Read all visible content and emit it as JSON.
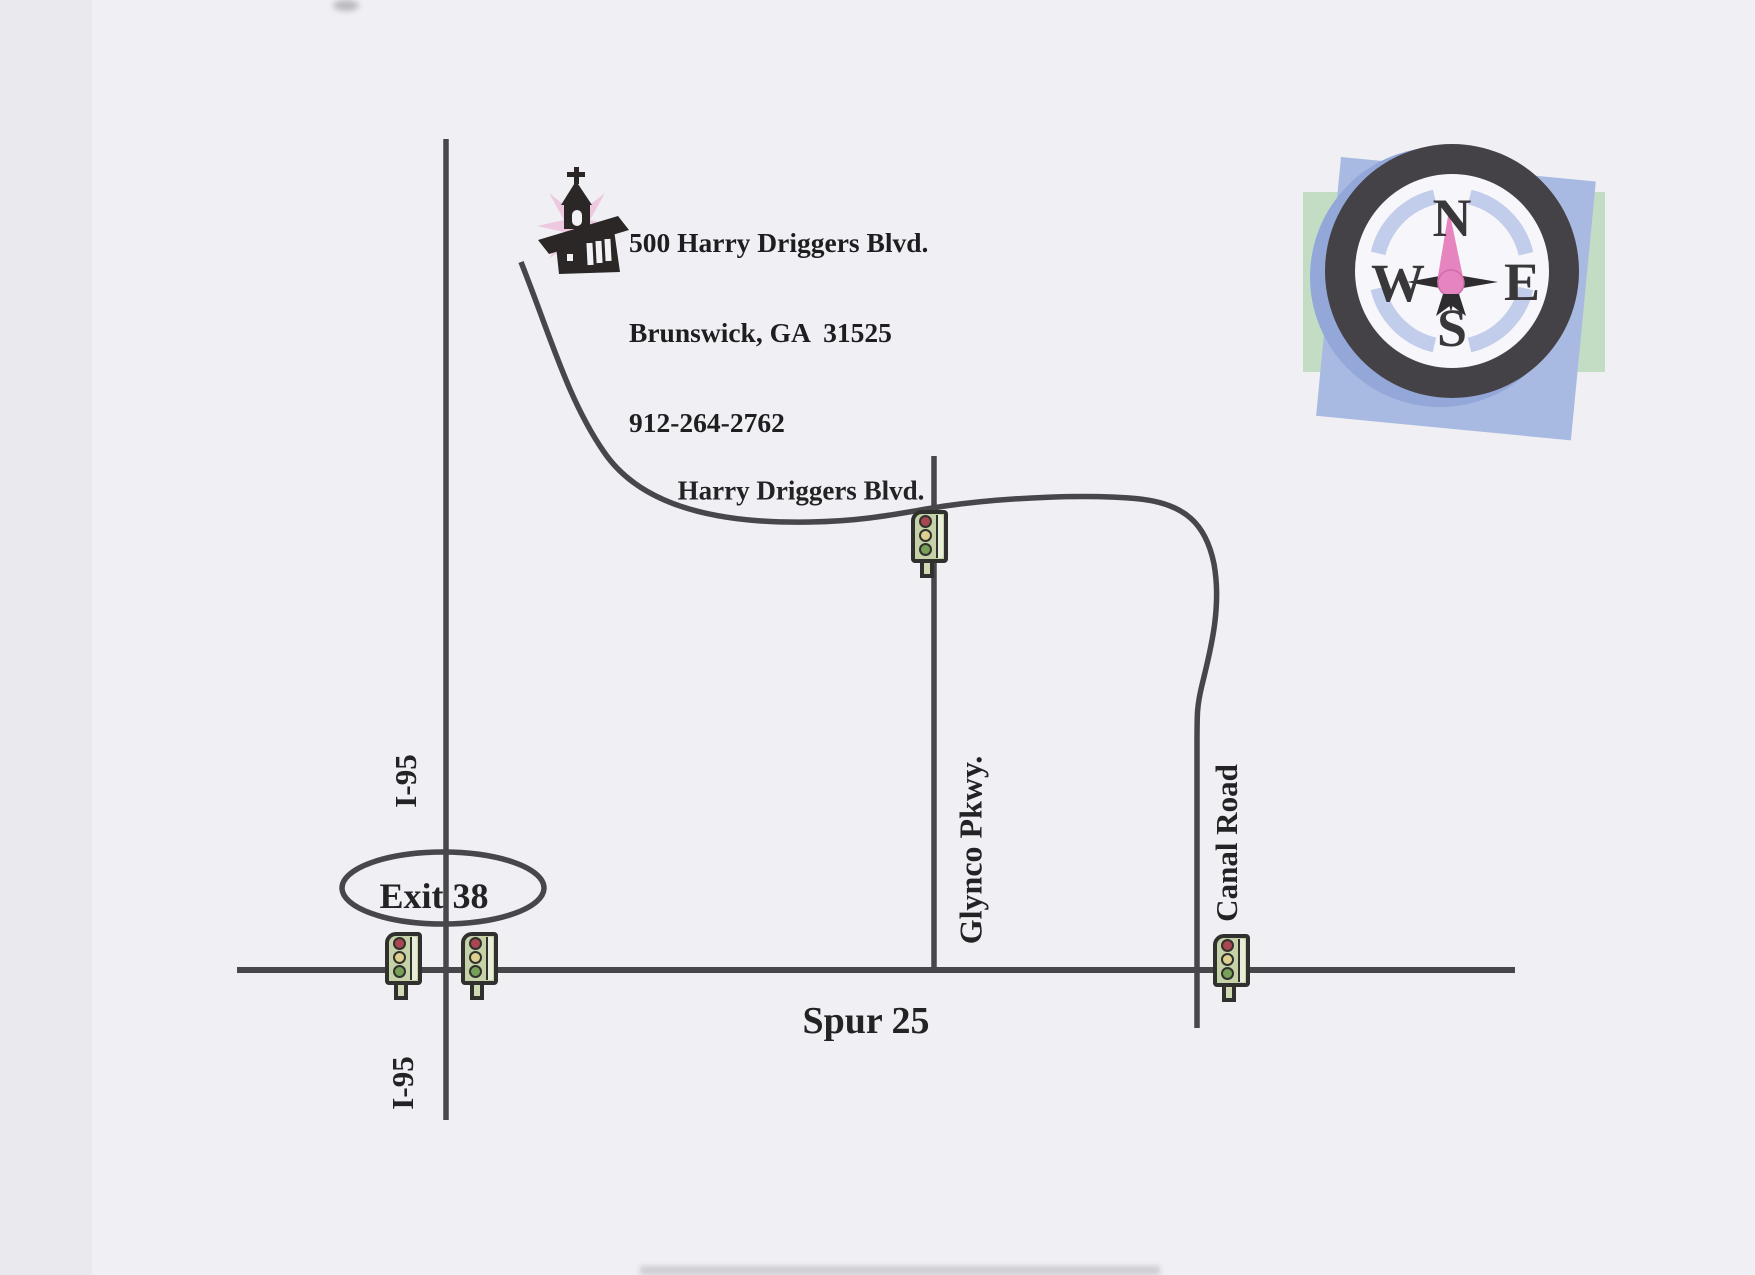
{
  "destination": {
    "address_line1": "500 Harry Driggers Blvd.",
    "address_line2": "Brunswick, GA  31525",
    "phone": "912-264-2762"
  },
  "roads": {
    "harry_driggers_blvd": "Harry Driggers Blvd.",
    "glynco_pkwy": "Glynco Pkwy.",
    "canal_road": "Canal Road",
    "spur_25": "Spur 25",
    "i95_north_label": "I-95",
    "i95_south_label": "I-95"
  },
  "exit": {
    "label": "Exit 38"
  },
  "compass": {
    "north": "N",
    "east": "E",
    "south": "S",
    "west": "W"
  },
  "icons": {
    "church": "church-icon",
    "compass_rose": "compass-rose-icon",
    "traffic_light": "traffic-light-icon"
  },
  "colors": {
    "road": "#47464a",
    "paper": "#f0f0f4",
    "compass_ring": "#454247",
    "compass_needle_pink": "#e584be",
    "compass_blue_square": "#a9bae2",
    "compass_green_rect": "#c3ddc5",
    "compass_arc_blue": "#c1cdeb",
    "traffic_light_body": "#c5d2a8",
    "traffic_light_red": "#a84750",
    "traffic_light_yellow": "#ddd08f",
    "traffic_light_green": "#76a058",
    "church_pink_burst": "#ecc3dd"
  }
}
